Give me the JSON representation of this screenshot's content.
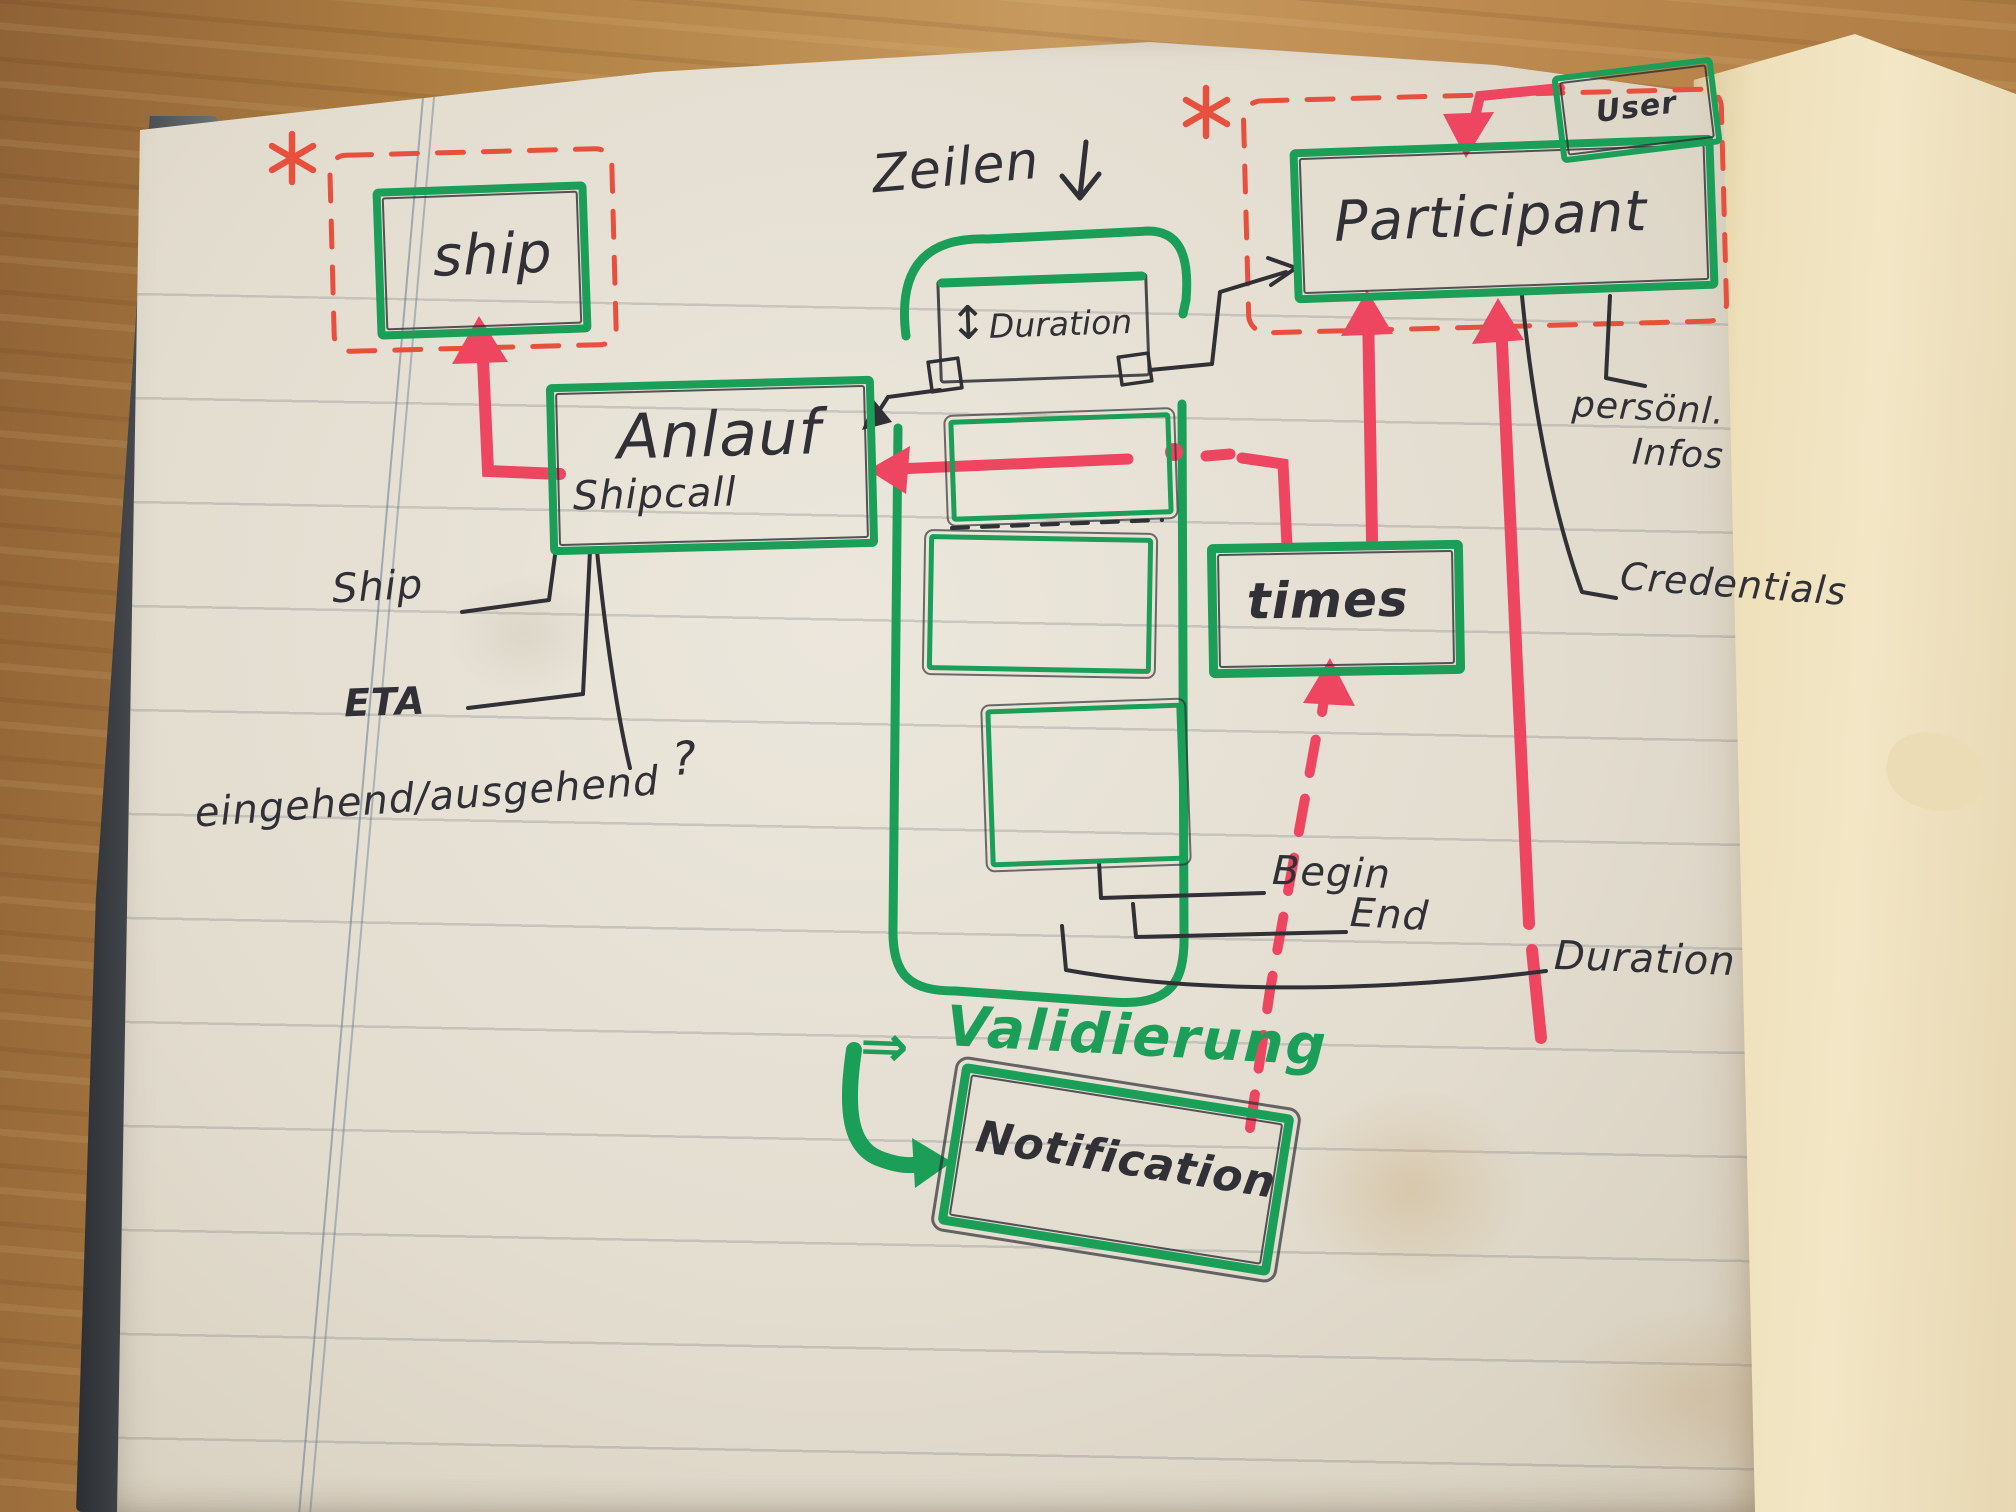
{
  "diagram": {
    "colors": {
      "marker_green": "#1b9e57",
      "marker_red": "#ee4660",
      "dashed_red": "#e8503e",
      "ink": "#303036",
      "page": "#e7e2d5",
      "wood": "#b5824a"
    },
    "entities": {
      "ship": {
        "label": "ship"
      },
      "anlauf": {
        "label": "Anlauf",
        "sublabel": "Shipcall"
      },
      "duration": {
        "label": "Duration",
        "updown_arrow": "↕"
      },
      "participant": {
        "label": "Participant"
      },
      "user": {
        "label": "User"
      },
      "times": {
        "label": "times"
      },
      "notification": {
        "label": "Notification"
      }
    },
    "labels": {
      "zeilen": "Zeilen",
      "ship_attr": "Ship",
      "eta_attr": "ETA",
      "inout_attr": "eingehend/ausgehend",
      "inout_question": "?",
      "begin": "Begin",
      "end": "End",
      "duration": "Duration",
      "personal_1": "persönl.",
      "personal_2": "Infos",
      "credentials": "Credentials",
      "validation_arrow": "⇒",
      "validation": "Validierung"
    }
  }
}
